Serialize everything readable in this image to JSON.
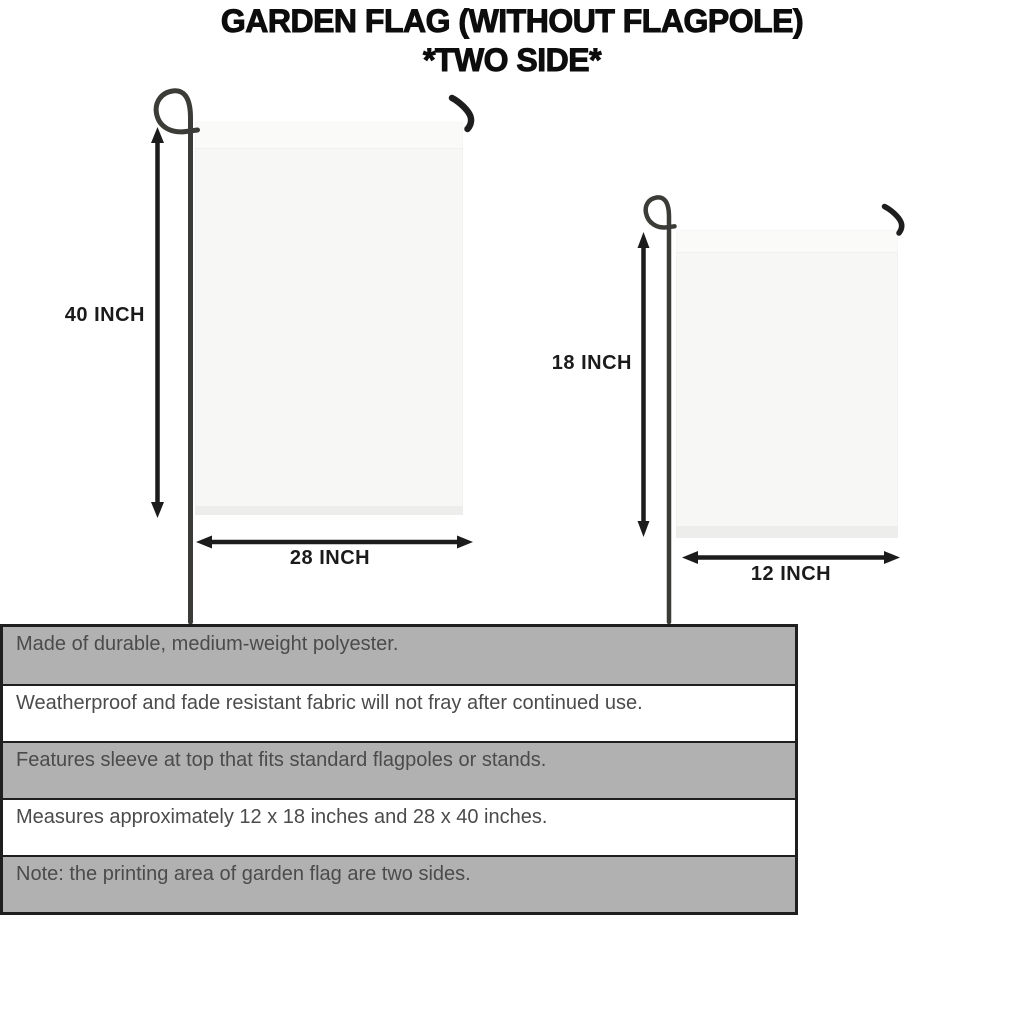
{
  "title": {
    "line1": "GARDEN FLAG (WITHOUT FLAGPOLE)",
    "line2": "*TWO SIDE*"
  },
  "diagram": {
    "large_flag": {
      "height_label": "40 INCH",
      "width_label": "28 INCH"
    },
    "small_flag": {
      "height_label": "18 INCH",
      "width_label": "12 INCH"
    }
  },
  "spec_table": {
    "rows": [
      {
        "text": "Made of durable, medium-weight polyester."
      },
      {
        "text": "Weatherproof and fade resistant fabric will not fray after continued use."
      },
      {
        "text": "Features sleeve at top that fits standard flagpoles or stands."
      },
      {
        "text": "Measures approximately 12 x 18 inches and 28 x 40 inches."
      },
      {
        "text": "Note: the printing area of garden flag are two sides."
      }
    ]
  },
  "colors": {
    "bg": "#ffffff",
    "title_text": "#0d0d0d",
    "label_text": "#1b1b1b",
    "row_gray": "#b1b1b1",
    "row_white": "#ffffff",
    "table_border": "#1f1f1f",
    "spec_text": "#4b4b4b",
    "flag_fill": "#f7f7f6",
    "flag_edge": "#ededeb",
    "pole": "#3b3b37",
    "hook": "#1e1e1e",
    "arrow": "#1c1c1c"
  }
}
